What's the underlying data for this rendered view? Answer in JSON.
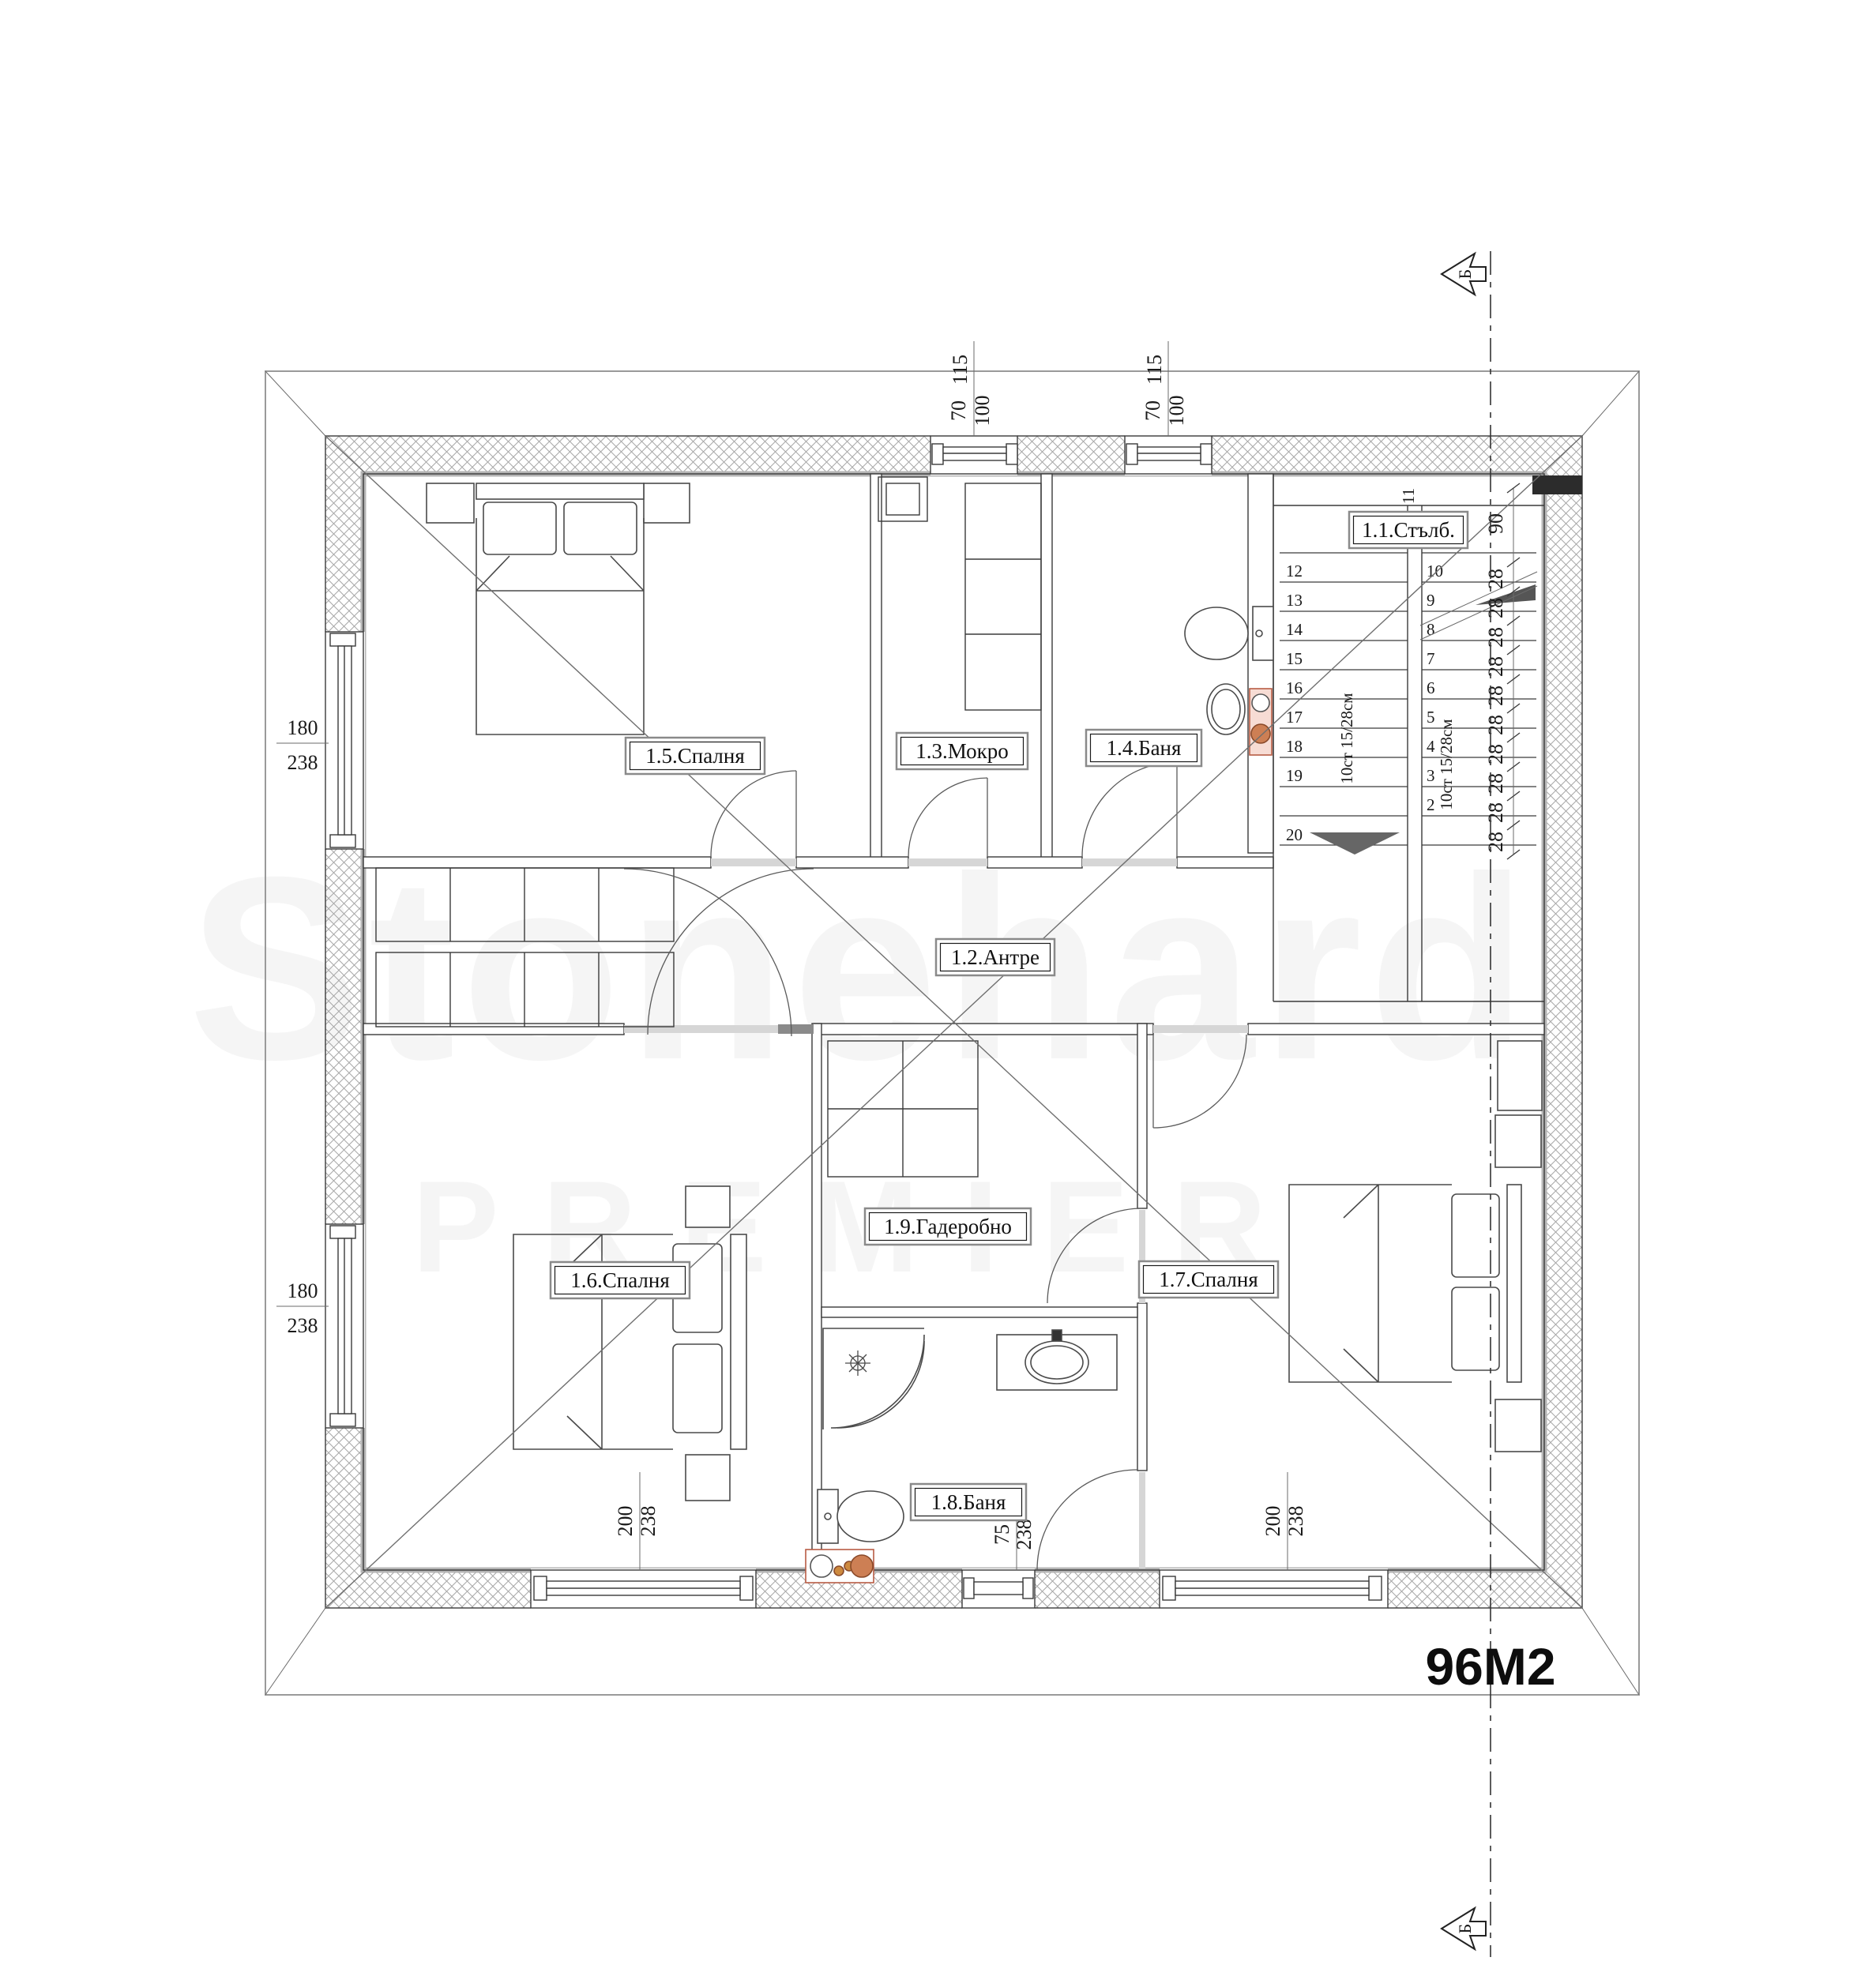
{
  "plan": {
    "area_label": "96М2",
    "section_marker": "Б",
    "watermark": {
      "line1": "Stonehard",
      "line2": "PREMIER"
    },
    "room_labels": {
      "stairs": "1.1.Стълб.",
      "hall": "1.2.Антре",
      "wet": "1.3.Мокро",
      "bath1": "1.4.Баня",
      "bed1": "1.5.Спалня",
      "bed2": "1.6.Спалня",
      "bed3": "1.7.Спалня",
      "bath2": "1.8.Баня",
      "wardrobe": "1.9.Гадеробно"
    },
    "dimensions": {
      "top_window_width": "115",
      "top_window_sill": "70",
      "top_window_height": "100",
      "side_window_width": "180",
      "side_window_height": "238",
      "bottom_window_width": "200",
      "bottom_small_width": "75",
      "window_height": "238",
      "stair_top": "90",
      "tread_depth": "28",
      "flight_note": "10ст 15/28см"
    },
    "stairs": {
      "left_treads": [
        "12",
        "13",
        "14",
        "15",
        "16",
        "17",
        "18",
        "19",
        "20"
      ],
      "right_treads": [
        "10",
        "9",
        "8",
        "7",
        "6",
        "5",
        "4",
        "3",
        "2"
      ],
      "mid_tread": "11"
    }
  }
}
